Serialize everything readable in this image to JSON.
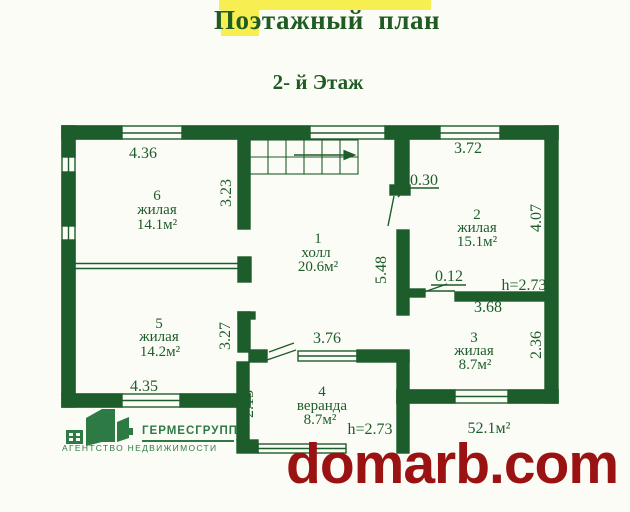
{
  "title": "Поэтажный  план",
  "subtitle": "2- й Этаж",
  "watermark": "domarb.com",
  "logo": {
    "name": "ГЕРМЕСГРУПП",
    "tagline": "АГЕНТСТВО НЕДВИЖИМОСТИ"
  },
  "plan": {
    "floor_total_area": "52.1м²",
    "rooms": [
      {
        "number": "1",
        "name": "холл",
        "area": "20.6м²"
      },
      {
        "number": "2",
        "name": "жилая",
        "area": "15.1м²"
      },
      {
        "number": "3",
        "name": "жилая",
        "area": "8.7м²"
      },
      {
        "number": "4",
        "name": "веранда",
        "area": "8.7м²"
      },
      {
        "number": "5",
        "name": "жилая",
        "area": "14.2м²"
      },
      {
        "number": "6",
        "name": "жилая",
        "area": "14.1м²"
      }
    ],
    "dims": {
      "room6_width": "4.36",
      "room6_height": "3.23",
      "room2_width": "3.72",
      "door_offset": "0.30",
      "room2_height": "4.07",
      "hall_height": "5.48",
      "wall_stub": "0.12",
      "ceiling_height": "h=2.73",
      "room3_width": "3.68",
      "room3_height": "2.36",
      "room5_wall": "3.27",
      "hall_width": "3.76",
      "room5_width": "4.35",
      "veranda_height": "2.13",
      "veranda_ceiling": "h=2.73"
    }
  },
  "colors": {
    "plan_green": "#1d5c2b",
    "title_green": "#1f5b22",
    "watermark_red": "#9a1212",
    "logo_green": "#2e7a45",
    "highlight_yellow": "#f7ef52"
  }
}
